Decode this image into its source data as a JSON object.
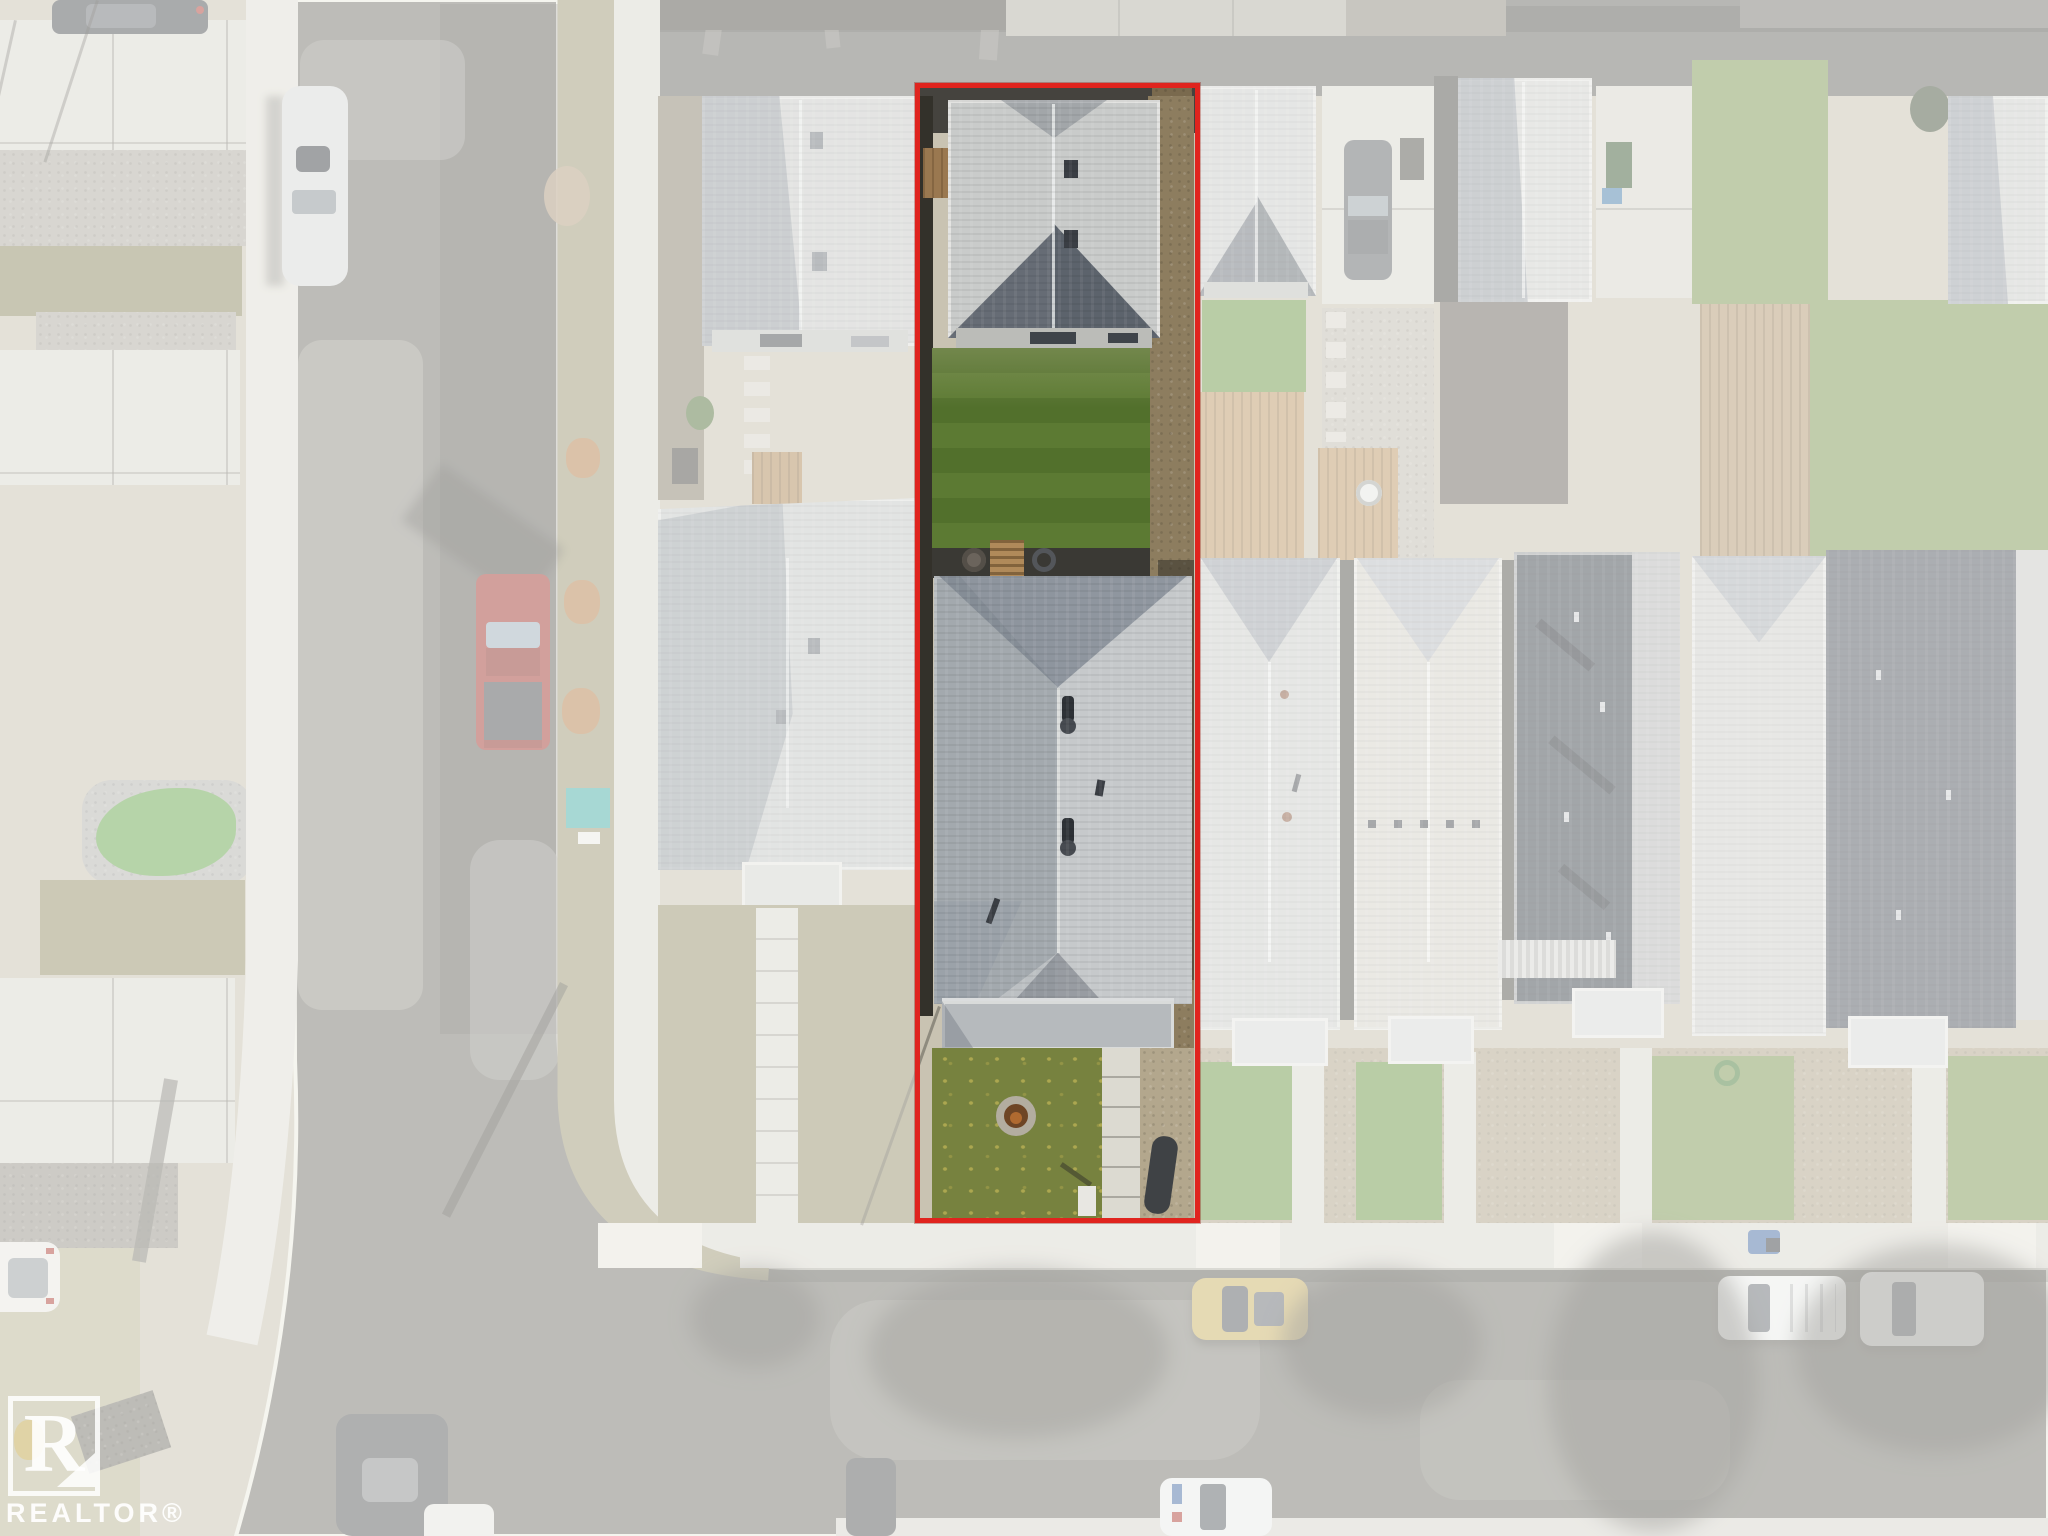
{
  "image": {
    "type": "aerial-drone-photo",
    "subject": "top-down view of a narrow residential infill lot outlined in red; surrounding neighborhood washed out in white",
    "season_cues": "autumn: leaf piles, dry boulevards, green sodded backyard"
  },
  "watermark": {
    "logo_letter": "R",
    "text": "REALTOR®"
  },
  "highlight": {
    "boundary_color": "#e0241e",
    "fade_color": "rgba(252,252,250,0.53)",
    "description": "red rectangular property-line overlay around the subject lot; everything outside is faded"
  },
  "palette": {
    "asphalt": "#77766f",
    "asphalt_patch": "#9b9a92",
    "alley": "#45433e",
    "alley_dark": "#55534e",
    "concrete": "#dcdad2",
    "concrete_bright": "#e9e7df",
    "curb": "#efede4",
    "boulevard": "#a09a77",
    "dry_grass": "#9a9270",
    "turf": "#69a84f",
    "lawn_green": "#5c7a33",
    "lawn_stripe": "#52702c",
    "front_lawn": "#77823f",
    "lawn_neighbor": "#6f9a4a",
    "lawn_neighbor2": "#7f9a55",
    "roof_light": "#c9cbca",
    "roof_mid": "#bcc0c3",
    "roof_shadow": "#5d646e",
    "roof_slope_shade": "#8e959e",
    "roof_dark": "#3f4650",
    "wood": "#b08a5a",
    "deck_wood": "#c09a68",
    "gravel": "#8d7d5f",
    "gravel_pale": "#b3a78d",
    "patio_dark": "#3a3934",
    "fence_dark": "#33312a",
    "red_line": "#e0241e",
    "truck_red": "#a33b33",
    "car_silver": "#d9dadb",
    "car_gold": "#cdb467",
    "car_white": "#eef0ef",
    "car_dark": "#4e5156",
    "white_wash": "rgba(252,252,250,0.53)"
  },
  "scene": {
    "subject_lot_features": [
      "rear garden suite with light gray gable roof and two roof vents",
      "striped green backyard lawn",
      "dark patio with fire bowl, wood ladder and coiled garden hose",
      "main house with large gray hip roof and two plumbing vent stacks",
      "front porch hip roof",
      "front lawn with circular stone fire-pit ring and leaf litter",
      "segmented concrete front walkway",
      "brown gravel side strips and dark fence-line shadow"
    ],
    "vehicles": [
      {
        "name": "dark-sedan",
        "color": "#4e5156",
        "location": "top-left parking pad, partially cropped"
      },
      {
        "name": "silver-car",
        "color": "#d9dadb",
        "location": "parked on left vertical street"
      },
      {
        "name": "red-pickup-truck",
        "color": "#a33b33",
        "location": "parked on left vertical street"
      },
      {
        "name": "gray-car",
        "color": "#63666b",
        "location": "rear parking pad right of subject lot"
      },
      {
        "name": "gold-car",
        "color": "#cdb467",
        "location": "bottom street, center-right"
      },
      {
        "name": "white-van-1",
        "color": "#eef0ef",
        "location": "bottom street, right"
      },
      {
        "name": "white-van-2",
        "color": "#eef0ef",
        "location": "bottom street, far right"
      },
      {
        "name": "white-car-bottom",
        "color": "#eceded",
        "location": "bottom street, center, cropped by frame"
      },
      {
        "name": "dark-suv",
        "color": "#595b5e",
        "location": "bottom street, left, cropped by frame"
      },
      {
        "name": "white-car-left-edge",
        "color": "#eceae6",
        "location": "left street near bottom, cropped"
      }
    ],
    "landmarks": [
      "rear alley along top edge",
      "left street curving into bottom street with radius corner",
      "boulevard grass with orange leaf piles and small bare tree",
      "concrete sidewalks with corner curve",
      "teal tarp on corner boulevard",
      "tree shadows across bottom street",
      "REALTOR watermark bottom-left"
    ]
  }
}
